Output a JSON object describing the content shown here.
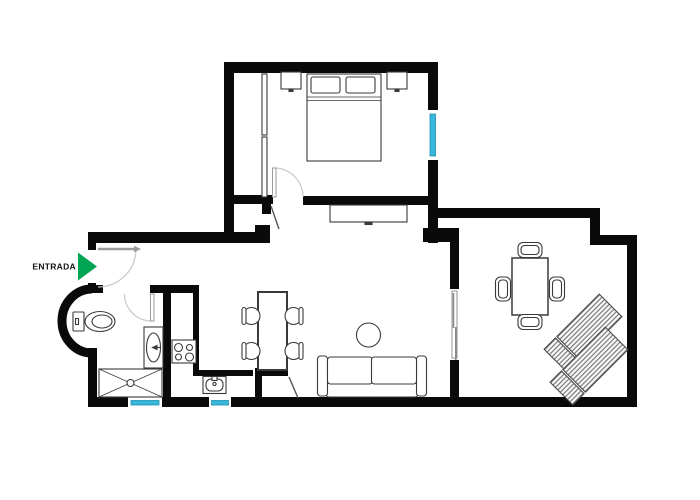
{
  "plan": {
    "entrance": {
      "label": "ENTRADA",
      "arrow_color": "#00A651"
    },
    "colors": {
      "wall": "#0a0a0a",
      "window": "#38b6db",
      "window_frame": "#1d8fae",
      "furniture": "#3a3a3a",
      "door": "#9b9b9b",
      "door_arc": "#c9c9c9",
      "background": "#ffffff"
    }
  }
}
